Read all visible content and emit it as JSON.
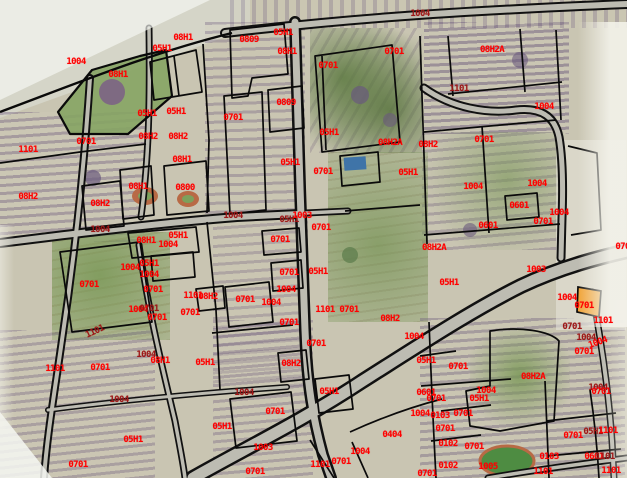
{
  "map": {
    "description": "Cadastral parcel map over aerial imagery",
    "colors": {
      "label_bright": "#ff0000",
      "label_dark": "#9e1616",
      "boundary": "#000000",
      "road_fill": "#bdbcb2",
      "satellite_base": "#c9c5b2",
      "highlight_parcel": "#f1a438",
      "pool": "#3f74a8",
      "field_green": "#4e8c42"
    },
    "labels": [
      {
        "t": "05H1",
        "x": 162,
        "y": 49,
        "c": "b"
      },
      {
        "t": "08H1",
        "x": 183,
        "y": 38,
        "c": "b"
      },
      {
        "t": "1004",
        "x": 76,
        "y": 62,
        "c": "b"
      },
      {
        "t": "08H1",
        "x": 118,
        "y": 75,
        "c": "b"
      },
      {
        "t": "0809",
        "x": 249,
        "y": 40,
        "c": "b"
      },
      {
        "t": "05H1",
        "x": 283,
        "y": 33,
        "c": "b"
      },
      {
        "t": "08H1",
        "x": 287,
        "y": 52,
        "c": "b"
      },
      {
        "t": "0701",
        "x": 328,
        "y": 66,
        "c": "b"
      },
      {
        "t": "0701",
        "x": 394,
        "y": 52,
        "c": "b"
      },
      {
        "t": "1004",
        "x": 420,
        "y": 14,
        "c": "d"
      },
      {
        "t": "08H2A",
        "x": 492,
        "y": 50,
        "c": "b"
      },
      {
        "t": "1101",
        "x": 459,
        "y": 89,
        "c": "d"
      },
      {
        "t": "1004",
        "x": 544,
        "y": 107,
        "c": "b"
      },
      {
        "t": "0701",
        "x": 484,
        "y": 140,
        "c": "b"
      },
      {
        "t": "1101",
        "x": 28,
        "y": 150,
        "c": "b"
      },
      {
        "t": "0701",
        "x": 86,
        "y": 142,
        "c": "b"
      },
      {
        "t": "05H1",
        "x": 147,
        "y": 114,
        "c": "b"
      },
      {
        "t": "05H1",
        "x": 176,
        "y": 112,
        "c": "b"
      },
      {
        "t": "0701",
        "x": 233,
        "y": 118,
        "c": "b"
      },
      {
        "t": "08H2",
        "x": 148,
        "y": 137,
        "c": "b"
      },
      {
        "t": "08H2",
        "x": 178,
        "y": 137,
        "c": "b"
      },
      {
        "t": "08H1",
        "x": 182,
        "y": 160,
        "c": "b"
      },
      {
        "t": "0809",
        "x": 286,
        "y": 103,
        "c": "b"
      },
      {
        "t": "05H1",
        "x": 329,
        "y": 133,
        "c": "b"
      },
      {
        "t": "08H1",
        "x": 138,
        "y": 187,
        "c": "b"
      },
      {
        "t": "0800",
        "x": 185,
        "y": 188,
        "c": "b"
      },
      {
        "t": "08H2",
        "x": 100,
        "y": 204,
        "c": "b"
      },
      {
        "t": "08H2",
        "x": 28,
        "y": 197,
        "c": "b"
      },
      {
        "t": "1004",
        "x": 100,
        "y": 230,
        "c": "d"
      },
      {
        "t": "08H1",
        "x": 146,
        "y": 241,
        "c": "b"
      },
      {
        "t": "05H1",
        "x": 178,
        "y": 236,
        "c": "b"
      },
      {
        "t": "1004",
        "x": 168,
        "y": 245,
        "c": "b"
      },
      {
        "t": "05H1",
        "x": 149,
        "y": 264,
        "c": "b"
      },
      {
        "t": "1004",
        "x": 130,
        "y": 268,
        "c": "b"
      },
      {
        "t": "1004",
        "x": 149,
        "y": 275,
        "c": "b"
      },
      {
        "t": "0701",
        "x": 89,
        "y": 285,
        "c": "b"
      },
      {
        "t": "0701",
        "x": 153,
        "y": 290,
        "c": "b"
      },
      {
        "t": "1101",
        "x": 193,
        "y": 296,
        "c": "b"
      },
      {
        "t": "0701",
        "x": 190,
        "y": 313,
        "c": "b"
      },
      {
        "t": "1004",
        "x": 138,
        "y": 310,
        "c": "b"
      },
      {
        "t": "0701",
        "x": 149,
        "y": 309,
        "c": "d"
      },
      {
        "t": "0701",
        "x": 157,
        "y": 318,
        "c": "b"
      },
      {
        "t": "1101",
        "x": 95,
        "y": 332,
        "c": "d",
        "r": -25
      },
      {
        "t": "1101",
        "x": 55,
        "y": 369,
        "c": "b"
      },
      {
        "t": "0701",
        "x": 100,
        "y": 368,
        "c": "b"
      },
      {
        "t": "1004",
        "x": 146,
        "y": 355,
        "c": "d"
      },
      {
        "t": "08H1",
        "x": 160,
        "y": 361,
        "c": "b"
      },
      {
        "t": "05H1",
        "x": 205,
        "y": 363,
        "c": "b"
      },
      {
        "t": "1004",
        "x": 119,
        "y": 400,
        "c": "d"
      },
      {
        "t": "05H1",
        "x": 133,
        "y": 440,
        "c": "b"
      },
      {
        "t": "0701",
        "x": 78,
        "y": 465,
        "c": "b"
      },
      {
        "t": "1004",
        "x": 233,
        "y": 216,
        "c": "d"
      },
      {
        "t": "05H1",
        "x": 289,
        "y": 220,
        "c": "d"
      },
      {
        "t": "1003",
        "x": 302,
        "y": 216,
        "c": "b"
      },
      {
        "t": "0701",
        "x": 321,
        "y": 228,
        "c": "b"
      },
      {
        "t": "0701",
        "x": 280,
        "y": 240,
        "c": "b"
      },
      {
        "t": "0701",
        "x": 289,
        "y": 273,
        "c": "b"
      },
      {
        "t": "05H1",
        "x": 318,
        "y": 272,
        "c": "b"
      },
      {
        "t": "1004",
        "x": 286,
        "y": 290,
        "c": "b"
      },
      {
        "t": "0701",
        "x": 245,
        "y": 300,
        "c": "b"
      },
      {
        "t": "1004",
        "x": 271,
        "y": 303,
        "c": "b"
      },
      {
        "t": "1101",
        "x": 325,
        "y": 310,
        "c": "b"
      },
      {
        "t": "0701",
        "x": 349,
        "y": 310,
        "c": "b"
      },
      {
        "t": "08H2",
        "x": 208,
        "y": 297,
        "c": "b"
      },
      {
        "t": "05H1",
        "x": 408,
        "y": 173,
        "c": "b"
      },
      {
        "t": "0701",
        "x": 323,
        "y": 172,
        "c": "b"
      },
      {
        "t": "05H1",
        "x": 290,
        "y": 163,
        "c": "b"
      },
      {
        "t": "08H2A",
        "x": 390,
        "y": 143,
        "c": "b"
      },
      {
        "t": "08H2",
        "x": 428,
        "y": 145,
        "c": "b"
      },
      {
        "t": "08H2A",
        "x": 434,
        "y": 248,
        "c": "b"
      },
      {
        "t": "0601",
        "x": 519,
        "y": 206,
        "c": "b"
      },
      {
        "t": "0601",
        "x": 488,
        "y": 226,
        "c": "b"
      },
      {
        "t": "1004",
        "x": 473,
        "y": 187,
        "c": "b"
      },
      {
        "t": "1004",
        "x": 537,
        "y": 184,
        "c": "b"
      },
      {
        "t": "1004",
        "x": 559,
        "y": 213,
        "c": "b"
      },
      {
        "t": "0701",
        "x": 543,
        "y": 222,
        "c": "b"
      },
      {
        "t": "05H1",
        "x": 449,
        "y": 283,
        "c": "b"
      },
      {
        "t": "1003",
        "x": 536,
        "y": 270,
        "c": "b"
      },
      {
        "t": "1004",
        "x": 567,
        "y": 298,
        "c": "b"
      },
      {
        "t": "0701",
        "x": 584,
        "y": 306,
        "c": "b"
      },
      {
        "t": "1101",
        "x": 603,
        "y": 321,
        "c": "b"
      },
      {
        "t": "0701",
        "x": 572,
        "y": 327,
        "c": "d"
      },
      {
        "t": "1004",
        "x": 586,
        "y": 338,
        "c": "d"
      },
      {
        "t": "1004",
        "x": 598,
        "y": 343,
        "c": "b",
        "r": -20
      },
      {
        "t": "0701",
        "x": 584,
        "y": 352,
        "c": "b"
      },
      {
        "t": "0701",
        "x": 289,
        "y": 323,
        "c": "b"
      },
      {
        "t": "0701",
        "x": 316,
        "y": 344,
        "c": "b"
      },
      {
        "t": "08H2",
        "x": 291,
        "y": 364,
        "c": "b"
      },
      {
        "t": "08H2",
        "x": 390,
        "y": 319,
        "c": "b"
      },
      {
        "t": "1004",
        "x": 414,
        "y": 337,
        "c": "b"
      },
      {
        "t": "1004",
        "x": 244,
        "y": 393,
        "c": "d"
      },
      {
        "t": "05H1",
        "x": 329,
        "y": 392,
        "c": "b"
      },
      {
        "t": "0701",
        "x": 275,
        "y": 412,
        "c": "b"
      },
      {
        "t": "05H1",
        "x": 222,
        "y": 427,
        "c": "b"
      },
      {
        "t": "1003",
        "x": 263,
        "y": 448,
        "c": "b"
      },
      {
        "t": "0404",
        "x": 392,
        "y": 435,
        "c": "b"
      },
      {
        "t": "1004",
        "x": 360,
        "y": 452,
        "c": "b"
      },
      {
        "t": "0701",
        "x": 341,
        "y": 462,
        "c": "b"
      },
      {
        "t": "1101",
        "x": 320,
        "y": 465,
        "c": "b"
      },
      {
        "t": "0701",
        "x": 255,
        "y": 472,
        "c": "b"
      },
      {
        "t": "05H1",
        "x": 426,
        "y": 361,
        "c": "b"
      },
      {
        "t": "0701",
        "x": 458,
        "y": 367,
        "c": "b"
      },
      {
        "t": "08H2A",
        "x": 533,
        "y": 377,
        "c": "b"
      },
      {
        "t": "0601",
        "x": 426,
        "y": 393,
        "c": "b"
      },
      {
        "t": "1004",
        "x": 486,
        "y": 391,
        "c": "b"
      },
      {
        "t": "0701",
        "x": 436,
        "y": 399,
        "c": "b"
      },
      {
        "t": "05H1",
        "x": 479,
        "y": 399,
        "c": "b"
      },
      {
        "t": "1004",
        "x": 420,
        "y": 414,
        "c": "b"
      },
      {
        "t": "0103",
        "x": 440,
        "y": 416,
        "c": "b"
      },
      {
        "t": "0701",
        "x": 463,
        "y": 414,
        "c": "b"
      },
      {
        "t": "0701",
        "x": 445,
        "y": 429,
        "c": "b"
      },
      {
        "t": "0102",
        "x": 448,
        "y": 444,
        "c": "b"
      },
      {
        "t": "0701",
        "x": 474,
        "y": 447,
        "c": "b"
      },
      {
        "t": "0102",
        "x": 448,
        "y": 466,
        "c": "b"
      },
      {
        "t": "1005",
        "x": 488,
        "y": 467,
        "c": "b"
      },
      {
        "t": "1101",
        "x": 543,
        "y": 472,
        "c": "b"
      },
      {
        "t": "0103",
        "x": 549,
        "y": 457,
        "c": "b"
      },
      {
        "t": "0701",
        "x": 573,
        "y": 436,
        "c": "b"
      },
      {
        "t": "05H1",
        "x": 593,
        "y": 432,
        "c": "d"
      },
      {
        "t": "1101",
        "x": 608,
        "y": 431,
        "c": "b"
      },
      {
        "t": "0601",
        "x": 594,
        "y": 457,
        "c": "b"
      },
      {
        "t": "1101",
        "x": 605,
        "y": 457,
        "c": "d"
      },
      {
        "t": "1004",
        "x": 598,
        "y": 388,
        "c": "d"
      },
      {
        "t": "0701",
        "x": 601,
        "y": 392,
        "c": "b"
      },
      {
        "t": "1101",
        "x": 611,
        "y": 471,
        "c": "b"
      },
      {
        "t": "0701",
        "x": 427,
        "y": 474,
        "c": "b"
      },
      {
        "t": "0701",
        "x": 625,
        "y": 247,
        "c": "b"
      }
    ]
  }
}
